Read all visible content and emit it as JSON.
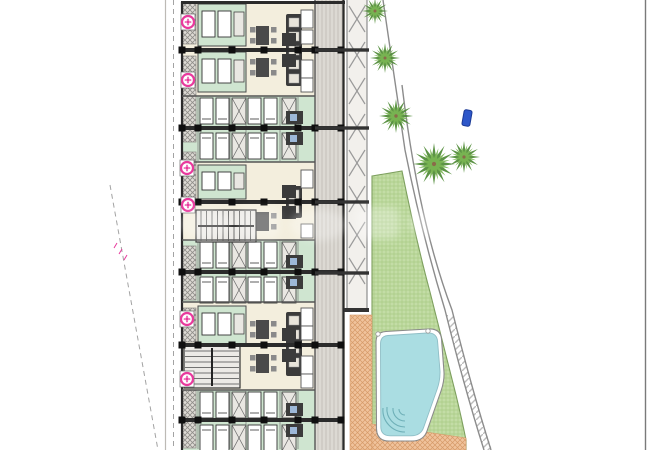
{
  "page": {
    "background": "#ffffff"
  },
  "drawing": {
    "type": "architectural-site-plan",
    "caption": "Site plan: residential block of repeating apartment units with corridor, pergola walkway, palm trees, lawn and swimming pool beside a curved road",
    "watermark": {
      "present": true,
      "legible": false
    },
    "elements": {
      "building": "apartment block",
      "corridor": "access corridor",
      "pergola": "trellis walkway",
      "walkway": "terracotta path",
      "lawn": "garden lawn",
      "pool": "swimming pool",
      "road": "curved road edge",
      "palm_tree_count": 5,
      "entrance_marker_count": 6
    }
  },
  "colors": {
    "paper": "#ffffff",
    "wall": "#2b2b2b",
    "wallNode": "#0f0f0f",
    "thinWall": "#555555",
    "cream": "#f3eedd",
    "mint": "#cfe5d0",
    "corridor": "#dcd9d3",
    "corridorLine": "#c3bfb8",
    "balcony": "#dedbd5",
    "balconyLine": "#8f8d89",
    "lawn": "#c3dda6",
    "lawnLine": "#a9cb85",
    "lawnEdge": "#7d9f5e",
    "pool": "#aadde2",
    "poolEdge": "#8fbec6",
    "poolStep": "#6fb0b8",
    "terracotta": "#f0c39c",
    "terracottaLine": "#d69a68",
    "palmDark": "#4e8a35",
    "palmLight": "#7ab553",
    "trunk": "#8a6b49",
    "pink": "#e83a9d",
    "blue": "#2e57c9",
    "blueDark": "#1b3a96",
    "road": "#8c8c8c",
    "roadHatch": "#b5b5b5",
    "boundary": "#7a7a7a",
    "dash": "#a3a3a3",
    "furnDark": "#3b3b3b",
    "furnMid": "#8a8a8a",
    "bedFill": "#ffffff",
    "bedLine": "#333333",
    "wardrobe": "#e9e7e2",
    "bathBlue": "#9db8d8",
    "stairFill": "#eceae6",
    "stairLine": "#4a4a4a",
    "pergolaBg": "#f2f0ec",
    "brace": "#9a9a9a"
  },
  "plan": {
    "pink_markers": [
      {
        "x": 188,
        "y": 22
      },
      {
        "x": 188,
        "y": 80
      },
      {
        "x": 187,
        "y": 168
      },
      {
        "x": 188,
        "y": 205
      },
      {
        "x": 187,
        "y": 319
      },
      {
        "x": 187,
        "y": 379
      }
    ],
    "palms": [
      {
        "x": 375,
        "y": 11,
        "r": 13
      },
      {
        "x": 385,
        "y": 58,
        "r": 15
      },
      {
        "x": 396,
        "y": 116,
        "r": 17
      },
      {
        "x": 434,
        "y": 164,
        "r": 21
      },
      {
        "x": 464,
        "y": 157,
        "r": 16
      }
    ],
    "blue_marker": {
      "x": 463,
      "y": 110,
      "w": 8,
      "h": 16,
      "rot": 10
    },
    "party_walls_y": [
      50,
      128,
      202,
      272,
      345,
      420
    ],
    "zone_lines_y": [
      96,
      162,
      240,
      302,
      390
    ],
    "beam_ys": [
      50,
      128,
      202,
      273
    ],
    "wall_node_xs": [
      182,
      198,
      232,
      264,
      298,
      315,
      341
    ],
    "pergola": {
      "x": 347,
      "width": 20,
      "top": 0,
      "bottom": 312,
      "brace_top": 6,
      "brace_step": 36,
      "brace_h": 26
    },
    "balcony_strips": [
      [
        2,
        44
      ],
      [
        56,
        142
      ],
      [
        152,
        198
      ],
      [
        246,
        300
      ],
      [
        308,
        342
      ],
      [
        390,
        448
      ]
    ],
    "mint_zones": [
      {
        "top": 96,
        "bottom": 162,
        "wall": 128
      },
      {
        "top": 240,
        "bottom": 302,
        "wall": 272
      },
      {
        "top": 390,
        "bottom": 450,
        "wall": 420
      }
    ],
    "cream_zones": [
      {
        "top": 3,
        "bottom": 96,
        "wall": 50,
        "green_rooms": [
          {
            "y": 4,
            "h": 42
          },
          {
            "y": 52,
            "h": 40
          }
        ],
        "kitchen": [
          14,
          72
        ],
        "tables": [
          26,
          58
        ],
        "couches": [
          10,
          30,
          60,
          78
        ]
      },
      {
        "top": 162,
        "bottom": 240,
        "wall": 202,
        "green_rooms": [
          {
            "y": 165,
            "h": 34
          }
        ],
        "kitchen": [
          186,
          32
        ],
        "tables": [
          212
        ],
        "couches": [
          170,
          224
        ]
      },
      {
        "top": 302,
        "bottom": 390,
        "wall": 345,
        "green_rooms": [
          {
            "y": 306,
            "h": 38
          }
        ],
        "kitchen": [
          312,
          64
        ],
        "tables": [
          320,
          354
        ],
        "couches": [
          308,
          326,
          356,
          374
        ]
      }
    ],
    "stairs": [
      {
        "x": 196,
        "y": 210,
        "w": 60,
        "h": 32,
        "run": "h"
      },
      {
        "x": 184,
        "y": 346,
        "w": 56,
        "h": 42,
        "run": "v"
      }
    ],
    "bed_xs": [
      200,
      216,
      248,
      264
    ],
    "wardrobe_xs": [
      232,
      282
    ],
    "thin_wall_xs": [
      198,
      230,
      246,
      280,
      298
    ]
  }
}
